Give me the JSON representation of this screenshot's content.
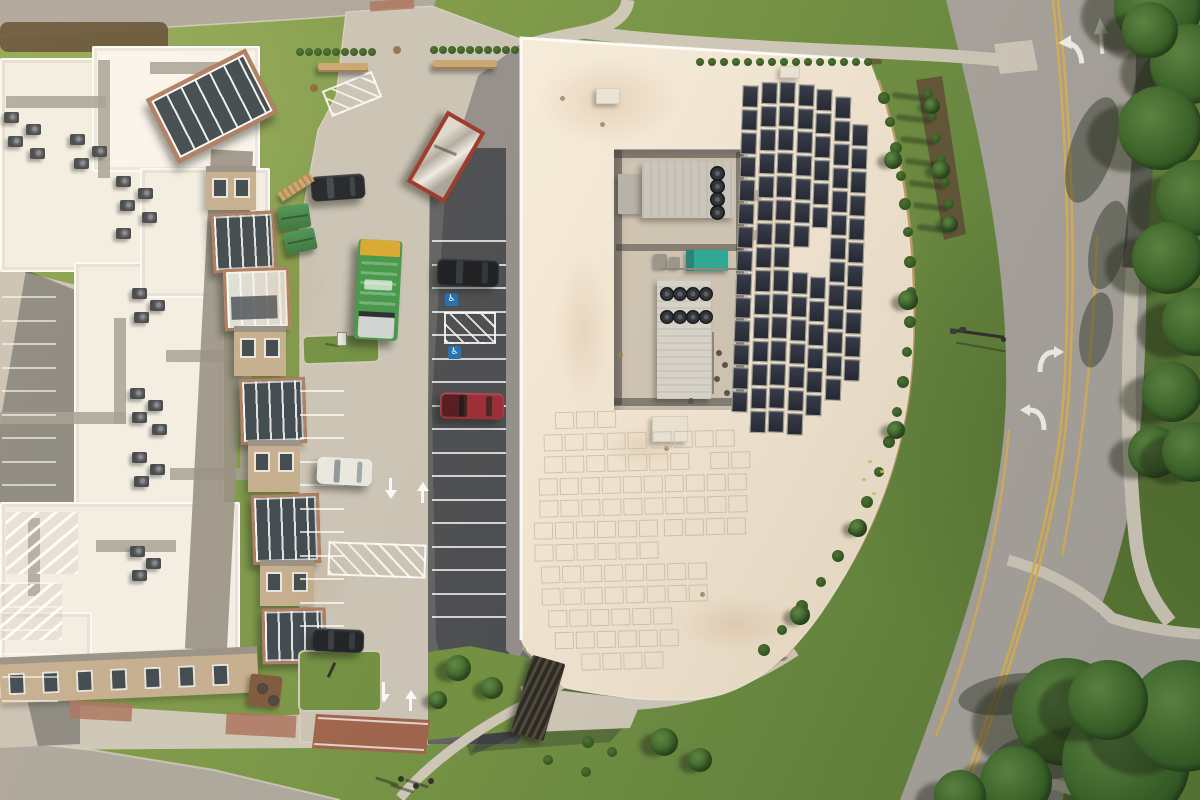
{
  "meta": {
    "description": "Aerial drone photo of a commercial building with rooftop solar panels, mechanical well, parking lot with vehicles, and a curving road",
    "width": 1200,
    "height": 800
  },
  "icons": {
    "handicap": "♿"
  },
  "palette": {
    "grass1": "#87a24c",
    "grass2": "#759343",
    "grass3": "#64853a",
    "grassDark": "#57762f",
    "roadA": "#aba59c",
    "roadB": "#a6a19a",
    "conc": "#c9c2b5",
    "concBright": "#d8d1c3",
    "asph": "#595a5c",
    "walk": "#cdc6b7",
    "trail": "#5b5d53",
    "brick": "#9b5f48",
    "brickLight": "#a8705c",
    "roofCream": "#f1e4d1",
    "roofWhite": "#f3efe6",
    "roofBright": "#f9f6f0",
    "wellFloor": "#cec3b2",
    "panel": "#272c38",
    "panelFrame": "#b8b09e",
    "hvac1": "#c9c5bc",
    "hvac2": "#d7d3ca",
    "fanDark": "#1f2228",
    "teal": "#28a794",
    "yline": "#d9ae50",
    "wline": "#f2efe8",
    "curbTan": "#c9996a",
    "mulch": "#5e4c33",
    "hedge": "#35591f",
    "tree1": "#4f7a35",
    "tree2": "#2e5220",
    "acBody": "#3e4248",
    "tan": "#c3ad8e",
    "brickBay": "#ad7a5d",
    "glassDark": "#39444c",
    "winFrame": "#e9e5db",
    "grayBand": "#938d82",
    "benchTan": "#c9a36e",
    "truckGreen": "#3f9447",
    "truckYellow": "#d7a62e",
    "containerRed": "#993327",
    "carBlack": "#1b1f24",
    "carRed": "#9b2730",
    "carWhite": "#e9e7e1",
    "poleDark": "#2f2d29",
    "shadow": "rgba(25,29,39,0.32)"
  },
  "scene": {
    "leftRoof": {
      "rects": [
        [
          0,
          58,
          196,
          214
        ],
        [
          92,
          46,
          168,
          126
        ],
        [
          74,
          262,
          150,
          300
        ],
        [
          0,
          502,
          240,
          162
        ],
        [
          140,
          168,
          130,
          130
        ],
        [
          0,
          612,
          92,
          86
        ]
      ],
      "paths": [
        [
          6,
          96,
          100,
          12
        ],
        [
          98,
          60,
          12,
          118
        ],
        [
          150,
          62,
          96,
          12
        ],
        [
          0,
          412,
          126,
          12
        ],
        [
          114,
          318,
          12,
          106
        ],
        [
          166,
          350,
          86,
          12
        ],
        [
          240,
          364,
          12,
          110
        ],
        [
          170,
          468,
          96,
          12
        ],
        [
          28,
          518,
          12,
          78
        ],
        [
          96,
          540,
          80,
          12
        ]
      ],
      "hatchZones": [
        [
          6,
          512,
          72,
          62
        ],
        [
          0,
          584,
          62,
          56
        ]
      ]
    },
    "acUnits": [
      [
        4,
        112
      ],
      [
        26,
        124
      ],
      [
        8,
        136
      ],
      [
        30,
        148
      ],
      [
        70,
        134
      ],
      [
        92,
        146
      ],
      [
        74,
        158
      ],
      [
        116,
        176
      ],
      [
        138,
        188
      ],
      [
        120,
        200
      ],
      [
        142,
        212
      ],
      [
        116,
        228
      ],
      [
        186,
        102
      ],
      [
        132,
        288
      ],
      [
        150,
        300
      ],
      [
        134,
        312
      ],
      [
        130,
        388
      ],
      [
        148,
        400
      ],
      [
        132,
        412
      ],
      [
        152,
        424
      ],
      [
        132,
        452
      ],
      [
        150,
        464
      ],
      [
        134,
        476
      ],
      [
        130,
        546
      ],
      [
        146,
        558
      ],
      [
        132,
        570
      ]
    ],
    "facade": {
      "grayBand": [
        198,
        150,
        42,
        500,
        3
      ],
      "glassWing": [
        156,
        70,
        104,
        64,
        -27
      ],
      "bays": [
        {
          "x": 206,
          "y": 166,
          "w": 50,
          "h": 44,
          "t": "wall"
        },
        {
          "x": 212,
          "y": 212,
          "w": 58,
          "h": 54,
          "t": "glass",
          "rot": -3
        },
        {
          "x": 224,
          "y": 268,
          "w": 60,
          "h": 56,
          "t": "glass2",
          "rot": -2
        },
        {
          "x": 234,
          "y": 326,
          "w": 52,
          "h": 50,
          "t": "wall"
        },
        {
          "x": 240,
          "y": 378,
          "w": 60,
          "h": 60,
          "t": "glass",
          "rot": -2
        },
        {
          "x": 248,
          "y": 440,
          "w": 52,
          "h": 52,
          "t": "wall"
        },
        {
          "x": 252,
          "y": 494,
          "w": 62,
          "h": 64,
          "t": "glass",
          "rot": -2
        },
        {
          "x": 260,
          "y": 560,
          "w": 54,
          "h": 46,
          "t": "wall"
        },
        {
          "x": 262,
          "y": 608,
          "w": 58,
          "h": 50,
          "t": "glass",
          "rot": -1
        }
      ],
      "bottomBand": [
        0,
        652,
        258,
        46,
        -2.5
      ],
      "bottomWindows": 7
    },
    "well": {
      "base": [
        612,
        147,
        134,
        261
      ],
      "strips": [
        [
          614,
          150,
          128,
          8
        ],
        [
          614,
          150,
          8,
          255
        ],
        [
          736,
          152,
          8,
          253
        ],
        [
          616,
          244,
          126,
          7
        ],
        [
          614,
          398,
          130,
          8
        ]
      ],
      "unitTopSmall": [
        618,
        174,
        24,
        40
      ],
      "unitTop": [
        642,
        162,
        92,
        56
      ],
      "fansTop": {
        "cx": 716,
        "cys": [
          172,
          185,
          198,
          211
        ],
        "r": 6.5
      },
      "teal": [
        686,
        250,
        42,
        21
      ],
      "pumps": [
        [
          654,
          254,
          13,
          15
        ],
        [
          669,
          257,
          11,
          12
        ]
      ],
      "unitBottom": [
        657,
        279,
        54,
        120
      ],
      "fansBottom": {
        "cxs": [
          666,
          679,
          692,
          705
        ],
        "cys": [
          293,
          316
        ],
        "r": 6
      },
      "pipeDots": [
        [
          716,
          350
        ],
        [
          722,
          362
        ],
        [
          714,
          376
        ],
        [
          724,
          390
        ],
        [
          688,
          398
        ]
      ],
      "sideBoxes": [
        [
          750,
          190,
          12,
          9
        ],
        [
          752,
          230,
          10,
          8
        ]
      ]
    },
    "solarA": {
      "cellW": 15.5,
      "cellH": 21.5,
      "pitch": 23.5,
      "rot": 2,
      "origin": [
        790,
        250
      ],
      "cols": [
        {
          "x": 737,
          "y": 87,
          "n": 14
        },
        {
          "x": 756,
          "y": 83,
          "n": 15
        },
        {
          "x": 774,
          "y": 82,
          "n": 15
        },
        {
          "x": 793,
          "y": 84,
          "n": 15,
          "skip": [
            7
          ]
        },
        {
          "x": 811,
          "y": 88,
          "n": 14,
          "skip": [
            6,
            7
          ]
        },
        {
          "x": 830,
          "y": 95,
          "n": 13
        },
        {
          "x": 848,
          "y": 122,
          "n": 11
        }
      ]
    },
    "solarB": {
      "cellW": 19,
      "gap": 2,
      "rowH": 17,
      "rot": -1.5,
      "origin": [
        640,
        530
      ],
      "rows": [
        {
          "y": 410,
          "segs": [
            [
              558,
              64
            ]
          ]
        },
        {
          "y": 432,
          "segs": [
            [
              546,
              100
            ],
            [
              655,
              92
            ]
          ]
        },
        {
          "y": 454,
          "segs": [
            [
              546,
              152
            ],
            [
              712,
              36
            ]
          ]
        },
        {
          "y": 476,
          "segs": [
            [
              540,
              206
            ]
          ]
        },
        {
          "y": 498,
          "segs": [
            [
              540,
              206
            ]
          ]
        },
        {
          "y": 520,
          "segs": [
            [
              534,
              118
            ],
            [
              664,
              82
            ]
          ]
        },
        {
          "y": 542,
          "segs": [
            [
              534,
              118
            ]
          ]
        },
        {
          "y": 564,
          "segs": [
            [
              540,
              178
            ]
          ]
        },
        {
          "y": 586,
          "segs": [
            [
              540,
              178
            ]
          ]
        },
        {
          "y": 608,
          "segs": [
            [
              546,
              136
            ]
          ]
        },
        {
          "y": 630,
          "segs": [
            [
              552,
              118
            ]
          ]
        },
        {
          "y": 652,
          "segs": [
            [
              578,
              86
            ]
          ]
        }
      ]
    },
    "roofBoxes": [
      [
        652,
        416,
        34,
        24
      ],
      [
        596,
        88,
        22,
        14
      ],
      [
        780,
        66,
        18,
        10
      ]
    ],
    "roofVents": [
      [
        560,
        96
      ],
      [
        600,
        122
      ],
      [
        790,
        98
      ],
      [
        664,
        446
      ],
      [
        700,
        592
      ],
      [
        618,
        352
      ]
    ],
    "stains": [
      {
        "x": 538,
        "y": 58,
        "w": 140,
        "h": 86,
        "o": 0.2
      },
      {
        "x": 556,
        "y": 255,
        "w": 54,
        "h": 150,
        "o": 0.16
      },
      {
        "x": 604,
        "y": 425,
        "w": 80,
        "h": 44,
        "o": 0.14
      },
      {
        "x": 676,
        "y": 596,
        "w": 120,
        "h": 56,
        "o": 0.16
      },
      {
        "x": 742,
        "y": 120,
        "w": 44,
        "h": 210,
        "o": 0.12
      },
      {
        "x": 236,
        "y": 220,
        "w": 90,
        "h": 130,
        "o": 0.12
      },
      {
        "x": 286,
        "y": 540,
        "w": 70,
        "h": 80,
        "o": 0.1
      }
    ],
    "stalls": [
      {
        "x": 432,
        "w": 74,
        "y0": 240,
        "step": 23.5,
        "n": 17,
        "o": 0.75
      },
      {
        "x": 300,
        "w": 44,
        "y0": 390,
        "step": 23.5,
        "n": 11,
        "o": 0.7
      },
      {
        "x": 2,
        "w": 54,
        "y0": 296,
        "step": 23.5,
        "n": 9,
        "o": 0.6
      },
      {
        "x": 2,
        "w": 56,
        "y0": 582,
        "step": 23.5,
        "n": 6,
        "o": 0.55
      }
    ],
    "hatchZones": [
      [
        444,
        312,
        48,
        28,
        0
      ],
      [
        328,
        543,
        94,
        30,
        2
      ],
      [
        325,
        80,
        50,
        24,
        -22
      ]
    ],
    "handicap": [
      [
        445,
        293
      ],
      [
        448,
        346
      ]
    ],
    "aisleArrows": [
      {
        "x": 390,
        "y": 478,
        "d": "down"
      },
      {
        "x": 422,
        "y": 482,
        "d": "up"
      },
      {
        "x": 383,
        "y": 682,
        "d": "down"
      },
      {
        "x": 410,
        "y": 690,
        "d": "up"
      }
    ],
    "grassIslands": [
      {
        "x": 302,
        "y": 334,
        "w": 74,
        "h": 26,
        "rot": -2
      },
      {
        "x": 298,
        "y": 650,
        "w": 80,
        "h": 58,
        "rot": 0
      }
    ],
    "cars": [
      {
        "n": "black-car-north",
        "x": 311,
        "y": 175,
        "w": 54,
        "h": 25,
        "rot": -4,
        "c": "carBlack",
        "win": "#3a4148"
      },
      {
        "n": "black-suv",
        "x": 437,
        "y": 259,
        "w": 62,
        "h": 27,
        "rot": 2,
        "c": "#15181d",
        "win": "#2e343b"
      },
      {
        "n": "red-pickup",
        "x": 440,
        "y": 393,
        "w": 64,
        "h": 26,
        "rot": 1,
        "c": "carRed",
        "win": "#321e20",
        "bed": true
      },
      {
        "n": "white-car",
        "x": 317,
        "y": 458,
        "w": 55,
        "h": 27,
        "rot": 3,
        "c": "carWhite",
        "win": "#8e959b"
      },
      {
        "n": "black-car-south",
        "x": 312,
        "y": 629,
        "w": 52,
        "h": 23,
        "rot": 2,
        "c": "#191d21",
        "win": "#32383e"
      }
    ],
    "truck": {
      "x": 356,
      "y": 240,
      "w": 44,
      "h": 100,
      "rot": 3
    },
    "container": {
      "x": 424,
      "y": 116,
      "w": 36,
      "h": 74,
      "rot": 30
    },
    "dumpsters": [
      [
        279,
        205,
        31,
        24,
        -8
      ],
      [
        285,
        230,
        31,
        22,
        -12
      ]
    ],
    "fence": [
      277,
      182,
      38,
      10,
      -33
    ],
    "benches": [
      [
        318,
        63,
        50,
        9
      ],
      [
        433,
        60,
        64,
        9
      ]
    ],
    "hedgeRows": [
      {
        "x0": 300,
        "y": 52,
        "n": 9,
        "step": 9
      },
      {
        "x0": 434,
        "y": 50,
        "n": 10,
        "step": 9
      },
      {
        "x0": 700,
        "y": 62,
        "n": 15,
        "step": 12
      }
    ],
    "hedgeCurve": [
      [
        884,
        98,
        6
      ],
      [
        890,
        122,
        5
      ],
      [
        896,
        148,
        6
      ],
      [
        901,
        176,
        5
      ],
      [
        905,
        204,
        6
      ],
      [
        908,
        232,
        5
      ],
      [
        910,
        262,
        6
      ],
      [
        911,
        292,
        5
      ],
      [
        910,
        322,
        6
      ],
      [
        907,
        352,
        5
      ],
      [
        903,
        382,
        6
      ],
      [
        897,
        412,
        5
      ],
      [
        889,
        442,
        6
      ],
      [
        879,
        472,
        5
      ],
      [
        867,
        502,
        6
      ],
      [
        853,
        530,
        5
      ],
      [
        838,
        556,
        6
      ],
      [
        821,
        582,
        5
      ],
      [
        802,
        606,
        6
      ],
      [
        782,
        630,
        5
      ],
      [
        764,
        650,
        6
      ]
    ],
    "hedgeTrees": [
      [
        893,
        160,
        9
      ],
      [
        908,
        300,
        10
      ],
      [
        896,
        430,
        9
      ],
      [
        858,
        528,
        9
      ],
      [
        800,
        615,
        10
      ]
    ],
    "mulchShrubs": [
      [
        928,
        94
      ],
      [
        932,
        116
      ],
      [
        936,
        138
      ],
      [
        941,
        160
      ],
      [
        945,
        182
      ],
      [
        949,
        204
      ],
      [
        953,
        226
      ]
    ],
    "mulchTrees": [
      [
        932,
        106,
        8
      ],
      [
        941,
        170,
        9
      ],
      [
        950,
        224,
        8
      ]
    ],
    "treesRight": [
      [
        1158,
        6,
        44
      ],
      [
        1190,
        64,
        40
      ],
      [
        1160,
        128,
        42
      ],
      [
        1194,
        198,
        38
      ],
      [
        1168,
        258,
        36
      ],
      [
        1196,
        322,
        34
      ],
      [
        1172,
        392,
        30
      ],
      [
        1154,
        452,
        26
      ],
      [
        1192,
        452,
        30
      ],
      [
        1150,
        30,
        28
      ],
      [
        1066,
        712,
        54
      ],
      [
        1126,
        762,
        64
      ],
      [
        1184,
        716,
        56
      ],
      [
        1016,
        782,
        36
      ],
      [
        1108,
        700,
        40
      ],
      [
        960,
        796,
        26
      ]
    ],
    "wedgeTrees": [
      [
        458,
        668,
        13
      ],
      [
        492,
        688,
        11
      ],
      [
        438,
        700,
        9
      ],
      [
        664,
        742,
        14
      ],
      [
        700,
        760,
        12
      ]
    ],
    "southShrubs": [
      [
        588,
        742,
        6
      ],
      [
        612,
        752,
        5
      ],
      [
        586,
        772,
        5
      ],
      [
        548,
        760,
        5
      ]
    ],
    "pergola": {
      "x": 521,
      "y": 658,
      "w": 34,
      "h": 80,
      "rot": 16
    },
    "patio": {
      "x": 249,
      "y": 675,
      "w": 32,
      "h": 32,
      "rot": 6,
      "tables": [
        [
          257,
          683
        ],
        [
          268,
          695
        ]
      ]
    },
    "people": [
      [
        398,
        776
      ],
      [
        413,
        783
      ],
      [
        428,
        778
      ]
    ],
    "lightPole": {
      "arm": [
        950,
        332,
        54,
        8
      ],
      "heads": [
        [
          950,
          329
        ],
        [
          959,
          327
        ]
      ],
      "base": [
        1001,
        337
      ]
    },
    "lamp2": [
      330,
      662
    ],
    "sign": [
      337,
      332
    ],
    "redAccents": [
      [
        70,
        702,
        62,
        18,
        3
      ],
      [
        226,
        714,
        70,
        22,
        3
      ],
      [
        370,
        0,
        44,
        10,
        -4
      ]
    ],
    "drains": [
      [
        393,
        46
      ],
      [
        310,
        84
      ]
    ],
    "leaves": [
      [
        862,
        478
      ],
      [
        872,
        492
      ],
      [
        880,
        470
      ],
      [
        868,
        460
      ]
    ]
  }
}
